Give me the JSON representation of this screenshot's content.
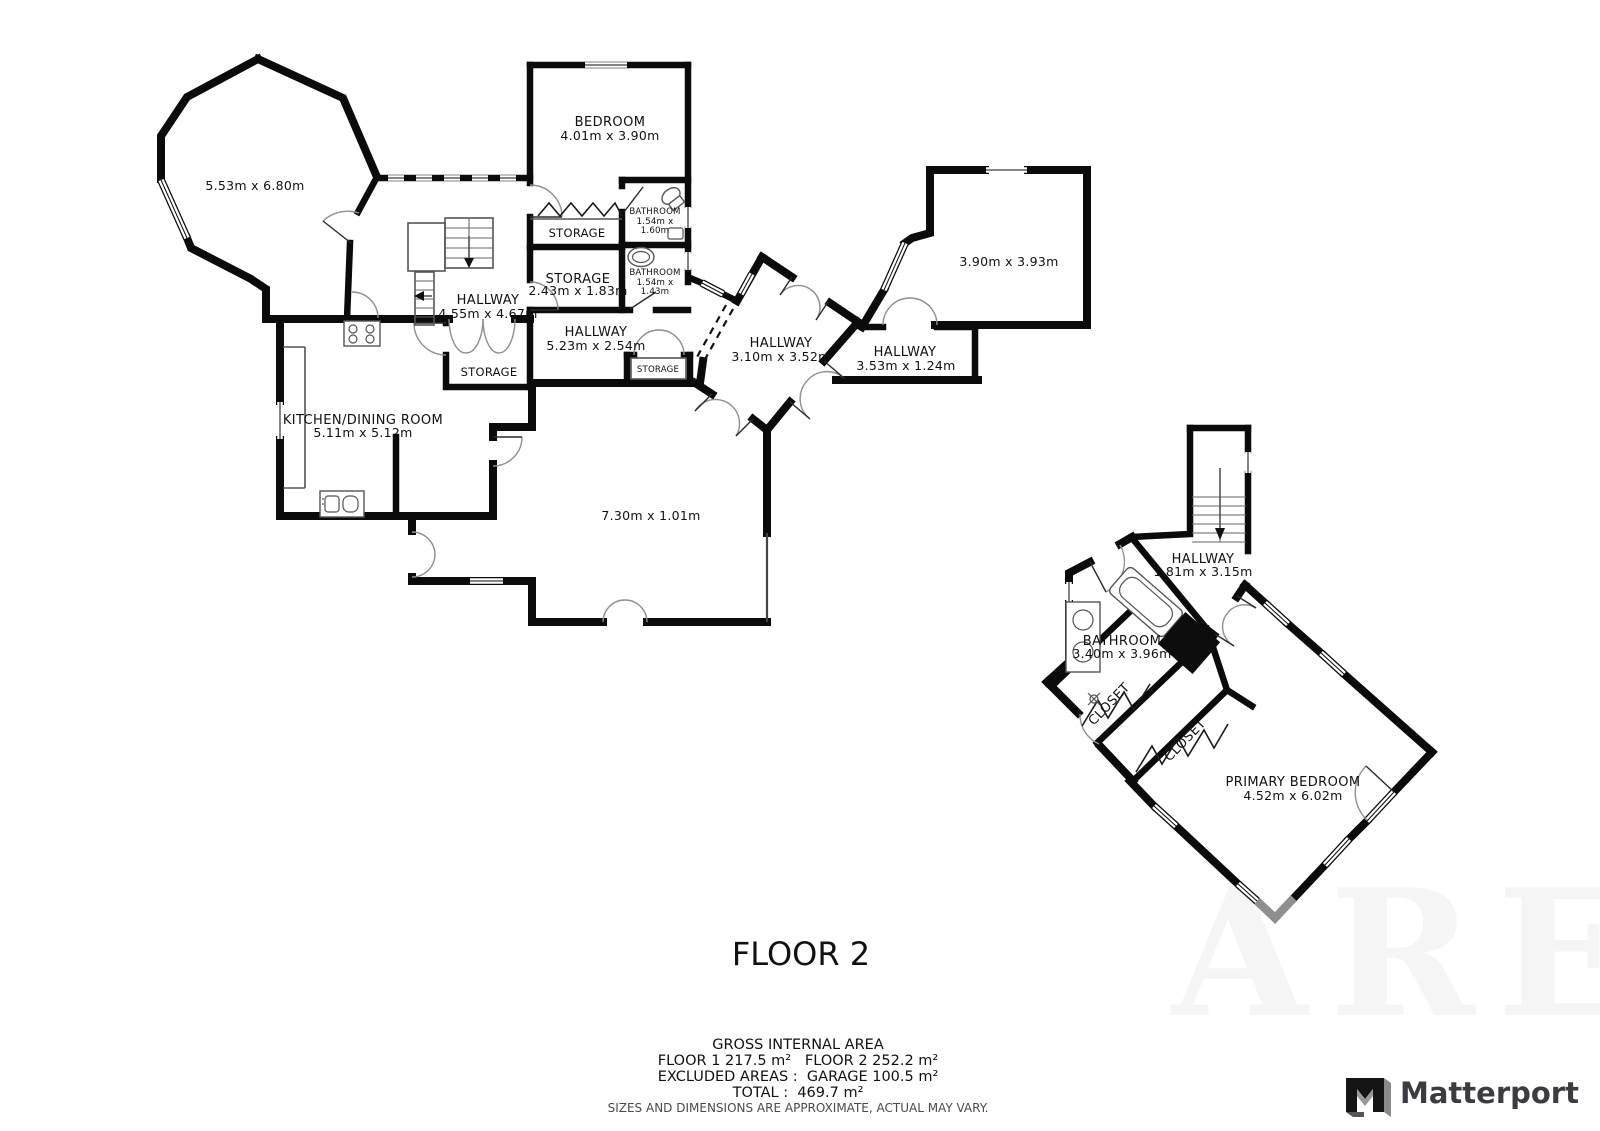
{
  "plan": {
    "rooms": {
      "octagon": {
        "dims": "5.53m x 6.80m"
      },
      "bedroom": {
        "name": "BEDROOM",
        "dims": "4.01m x 3.90m"
      },
      "bathroom_top": {
        "name": "BATHROOM",
        "dims_line1": "1.54m x",
        "dims_line2": "1.60m"
      },
      "storage_strip": {
        "name": "STORAGE"
      },
      "storage_mid": {
        "name": "STORAGE",
        "dims": "2.43m x 1.83m"
      },
      "bathroom_mid": {
        "name": "BATHROOM",
        "dims_line1": "1.54m x",
        "dims_line2": "1.43m"
      },
      "hallway_main": {
        "name": "HALLWAY",
        "dims": "4.55m x 4.67m"
      },
      "hallway_center": {
        "name": "HALLWAY",
        "dims": "5.23m x 2.54m"
      },
      "storage_lower": {
        "name": "STORAGE"
      },
      "storage_small": {
        "name": "STORAGE"
      },
      "hallway_diamond": {
        "name": "HALLWAY",
        "dims": "3.10m x 3.52m"
      },
      "hallway_strip": {
        "name": "HALLWAY",
        "dims": "3.53m x 1.24m"
      },
      "room_390": {
        "dims": "3.90m x 3.93m"
      },
      "kitchen": {
        "name": "KITCHEN/DINING ROOM",
        "dims": "5.11m x 5.12m"
      },
      "room_730": {
        "dims": "7.30m x 1.01m"
      },
      "hallway_suite": {
        "name": "HALLWAY",
        "dims": "1.81m x 3.15m"
      },
      "bathroom_suite": {
        "name": "BATHROOM",
        "dims": "3.40m x 3.96m"
      },
      "closet_a": {
        "name": "CLOSET"
      },
      "closet_b": {
        "name": "CLOSET"
      },
      "primary_bedroom": {
        "name": "PRIMARY BEDROOM",
        "dims": "4.52m x 6.02m"
      }
    },
    "floor_title": "FLOOR 2",
    "area_summary": {
      "heading": "GROSS INTERNAL AREA",
      "line1": "FLOOR 1 217.5 m²   FLOOR 2 252.2 m²",
      "line2": "EXCLUDED AREAS :  GARAGE 100.5 m²",
      "line3": "TOTAL :  469.7 m²",
      "disclaimer": "SIZES AND DIMENSIONS ARE APPROXIMATE, ACTUAL MAY VARY."
    },
    "brand": {
      "name": "Matterport"
    },
    "watermark": "ARE"
  }
}
